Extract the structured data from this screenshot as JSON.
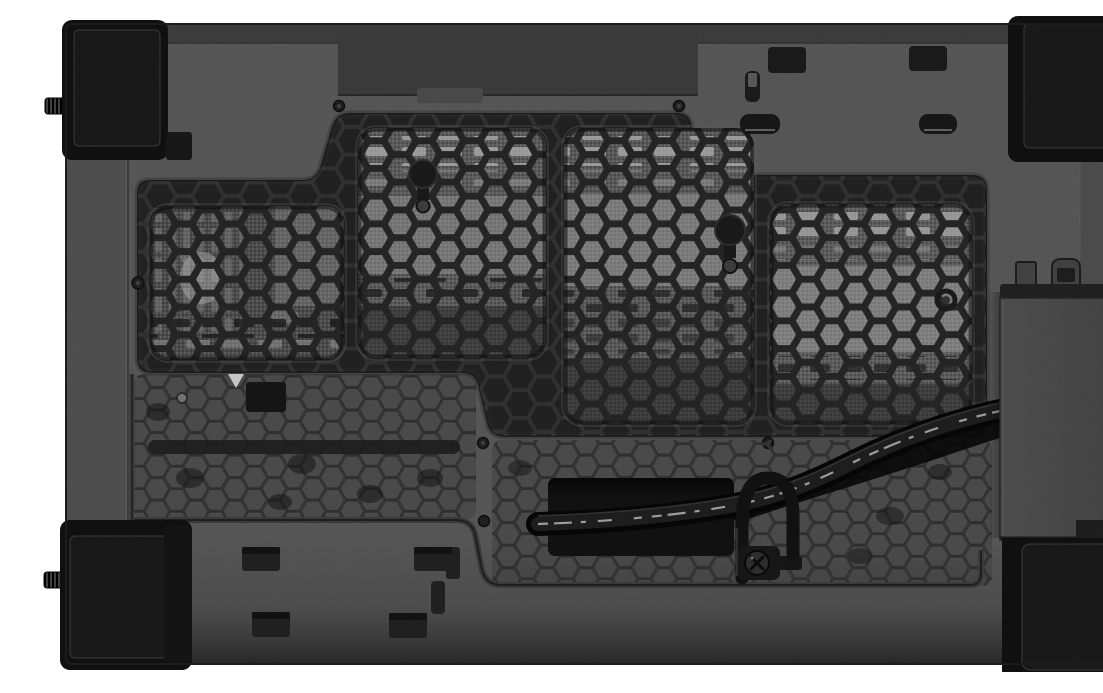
{
  "scene": {
    "type": "product-photograph",
    "alt": "Bottom exterior view of a black steel PC case lying flat on a white background. A large stepped recess holds a honeycomb dust filter with four fine-mesh windows through which the lighter interior is visible. Below it is a hexagon-perforated vent area with a rectangular cable cutout. A flat black ribbon cable with fine white printing runs from under a raised side bracket, is secured by a screwed metal cable clamp, and disappears into the cutout. Four black rubber corner feet and two knurled side thumbscrews are visible, along with small stamped slots and screw holes.",
    "background_color": "#ffffff"
  },
  "palette": {
    "background": "#ffffff",
    "body": "#525252",
    "top_wall": "#393939",
    "dark_vent_band": "#383838",
    "recess_frame": "#262626",
    "groove": "#414141",
    "hex_web": "#232323",
    "hex_small_line": "#2d2d2d",
    "mesh_base": "#575757",
    "interior_light": "#9a9a9a",
    "dash_light": "#a6a6a6",
    "dash_dark": "#141414",
    "foot": "#0f0f0f",
    "foot_pad": "#181818",
    "block": "#454545",
    "cable": "#050505",
    "cable_print": "#cfcfcf",
    "opening": "#101010"
  },
  "parts": {
    "case_bottom_panel": "textured black case bottom panel",
    "dust_filter": {
      "label": "honeycomb dust filter",
      "window_count": 4
    },
    "filter_windows": [
      "left mesh window",
      "center-left mesh window",
      "center mesh window",
      "right mesh window"
    ],
    "vent_area_left": "small hexagon perforated vent (lower left)",
    "vent_area_right": "small hexagon perforated vent (lower right)",
    "cable_opening": "rectangular cable pass-through cutout",
    "ribbon_cable": {
      "label": "flat black ribbon cable",
      "print": "illegible fine white print"
    },
    "cable_clamp": "metal cable clamp with Phillips screw",
    "side_bracket": "raised side bracket block with two retention tabs",
    "feet": [
      "top-left rubber foot",
      "top-right rubber foot",
      "bottom-left rubber foot",
      "bottom-right rubber foot"
    ],
    "thumbscrews": [
      "upper-left knurled thumbscrew",
      "lower-left knurled thumbscrew"
    ],
    "fasteners": "countersunk screws along the filter lip and vent area"
  }
}
